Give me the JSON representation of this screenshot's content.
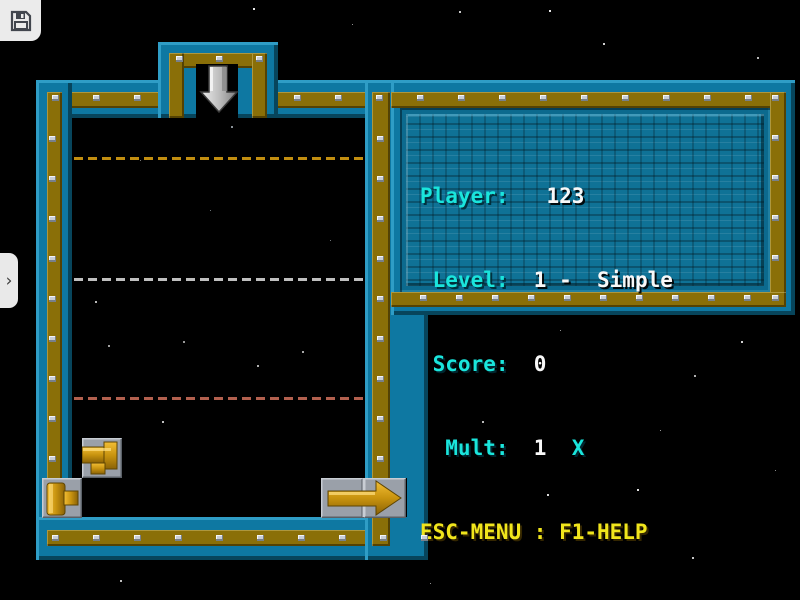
{
  "hud": {
    "rows": [
      {
        "label": "Player:",
        "value": "   123",
        "suffix": ""
      },
      {
        "label": " Level:",
        "value": "  1 -  Simple",
        "suffix": ""
      },
      {
        "label": " Score:",
        "value": "  0",
        "suffix": ""
      },
      {
        "label": "  Mult:",
        "value": "  1  ",
        "suffix": "X"
      }
    ],
    "help_line": "ESC-MENU : F1-HELP"
  },
  "chrome": {
    "save_icon": "floppy-disk-icon",
    "drawer_chevron": "›"
  },
  "board": {
    "drop_arrow": "down-arrow-icon",
    "guide_lines": [
      {
        "y": 157,
        "color": "#c28e10"
      },
      {
        "y": 278,
        "color": "#bfbfbf"
      },
      {
        "y": 397,
        "color": "#b2604e"
      }
    ],
    "pieces": [
      {
        "name": "tee-pipe-piece",
        "x": 82,
        "y": 438
      },
      {
        "name": "cap-pipe-piece",
        "x": 42,
        "y": 478
      },
      {
        "name": "arrow-piece",
        "x": 321,
        "y": 478
      }
    ]
  },
  "colors": {
    "wall_teal": "#0e78a2",
    "wall_olive": "#8a6f08",
    "panel_blue": "#0f7296",
    "label_cyan": "#1ae5dc",
    "value_white": "#f8f8f8",
    "help_yellow": "#f0e51c",
    "piece_gold": "#d09a12",
    "tile_gray": "#9aa0a9"
  },
  "decor": {
    "rivet_bands": [
      {
        "x": 52,
        "y": 95,
        "dx": 41,
        "dy": 0,
        "count": 3
      },
      {
        "x": 294,
        "y": 95,
        "dx": 41,
        "dy": 0,
        "count": 12
      },
      {
        "x": 176,
        "y": 56,
        "dx": 40,
        "dy": 0,
        "count": 3
      },
      {
        "x": 49,
        "y": 136,
        "dx": 0,
        "dy": 40,
        "count": 10
      },
      {
        "x": 52,
        "y": 535,
        "dx": 41,
        "dy": 0,
        "count": 10
      },
      {
        "x": 377,
        "y": 136,
        "dx": 0,
        "dy": 40,
        "count": 10
      },
      {
        "x": 772,
        "y": 95,
        "dx": 0,
        "dy": 40,
        "count": 6
      },
      {
        "x": 420,
        "y": 295,
        "dx": 36,
        "dy": 0,
        "count": 10
      }
    ],
    "stars": [
      {
        "x": 253,
        "y": 8,
        "s": 2,
        "c": "#e8e8e8"
      },
      {
        "x": 459,
        "y": 11,
        "s": 2,
        "c": "#c8c8c8"
      },
      {
        "x": 549,
        "y": 10,
        "s": 2,
        "c": "#e8e8e8"
      },
      {
        "x": 603,
        "y": 43,
        "s": 2,
        "c": "#d0d0d0"
      },
      {
        "x": 757,
        "y": 57,
        "s": 2,
        "c": "#b8b8b8"
      },
      {
        "x": 352,
        "y": 24,
        "s": 1,
        "c": "#909090"
      },
      {
        "x": 576,
        "y": 152,
        "s": 2,
        "c": "#d8d8d8"
      },
      {
        "x": 702,
        "y": 179,
        "s": 2,
        "c": "#c0c0c0"
      },
      {
        "x": 763,
        "y": 230,
        "s": 2,
        "c": "#e0e0e0"
      },
      {
        "x": 741,
        "y": 341,
        "s": 2,
        "c": "#d0d0d0"
      },
      {
        "x": 694,
        "y": 375,
        "s": 2,
        "c": "#b0b0b0"
      },
      {
        "x": 637,
        "y": 489,
        "s": 2,
        "c": "#e0e0e0"
      },
      {
        "x": 692,
        "y": 557,
        "s": 2,
        "c": "#c8c8c8"
      },
      {
        "x": 547,
        "y": 494,
        "s": 2,
        "c": "#d8d8d8"
      },
      {
        "x": 482,
        "y": 421,
        "s": 2,
        "c": "#b8b8b8"
      },
      {
        "x": 302,
        "y": 351,
        "s": 2,
        "c": "#a8a8a8"
      },
      {
        "x": 183,
        "y": 341,
        "s": 2,
        "c": "#989898"
      },
      {
        "x": 257,
        "y": 365,
        "s": 2,
        "c": "#b0b0b0"
      },
      {
        "x": 162,
        "y": 421,
        "s": 2,
        "c": "#c0c0c0"
      },
      {
        "x": 108,
        "y": 345,
        "s": 2,
        "c": "#a0a0a0"
      },
      {
        "x": 95,
        "y": 301,
        "s": 2,
        "c": "#b8b8b8"
      },
      {
        "x": 231,
        "y": 126,
        "s": 2,
        "c": "#8a9298"
      },
      {
        "x": 560,
        "y": 330,
        "s": 1,
        "c": "#909090"
      },
      {
        "x": 660,
        "y": 430,
        "s": 1,
        "c": "#989898"
      },
      {
        "x": 775,
        "y": 470,
        "s": 1,
        "c": "#888888"
      },
      {
        "x": 120,
        "y": 580,
        "s": 2,
        "c": "#c0c0c0"
      },
      {
        "x": 430,
        "y": 583,
        "s": 1,
        "c": "#909090"
      },
      {
        "x": 210,
        "y": 210,
        "s": 1,
        "c": "#6a7276"
      },
      {
        "x": 140,
        "y": 160,
        "s": 1,
        "c": "#777777"
      },
      {
        "x": 330,
        "y": 240,
        "s": 1,
        "c": "#6f7478"
      }
    ]
  }
}
